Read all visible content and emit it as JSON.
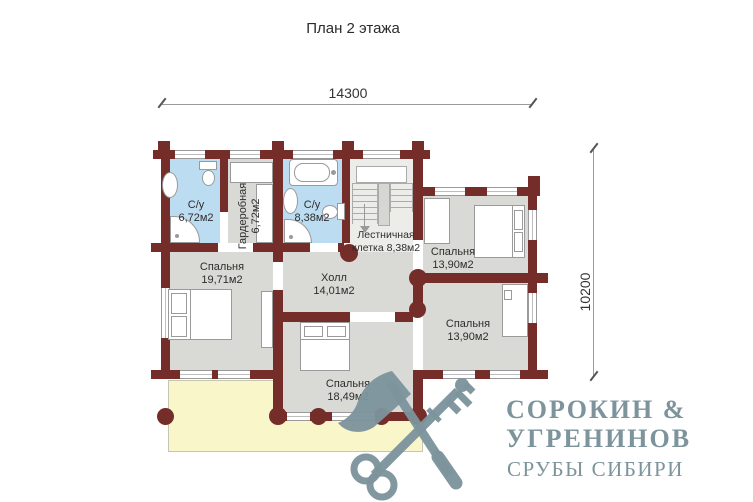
{
  "title": "План 2 этажа",
  "dimensions": {
    "width_mm": "14300",
    "height_mm": "10200"
  },
  "rooms": [
    {
      "name": "С/у",
      "area": "6,72м2"
    },
    {
      "name": "Гардеробная",
      "area": "6,72м2"
    },
    {
      "name": "С/у",
      "area": "8,38м2"
    },
    {
      "name": "Лестничная",
      "area": "клетка 8,38м2"
    },
    {
      "name": "Спальня",
      "area": "13,90м2"
    },
    {
      "name": "Спальня",
      "area": "19,71м2"
    },
    {
      "name": "Холл",
      "area": "14,01м2"
    },
    {
      "name": "Спальня",
      "area": "13,90м2"
    },
    {
      "name": "Спальня",
      "area": "18,49м2"
    }
  ],
  "logo": {
    "line1": "СОРОКИН &",
    "line2": "УГРЕНИНОВ",
    "line3": "СРУБЫ СИБИРИ"
  },
  "colors": {
    "wall": "#742d28",
    "room": "#d9d9d5",
    "bathroom": "#bcdcf2",
    "balcony": "#f9f6c9",
    "logo": "#7d949c"
  }
}
